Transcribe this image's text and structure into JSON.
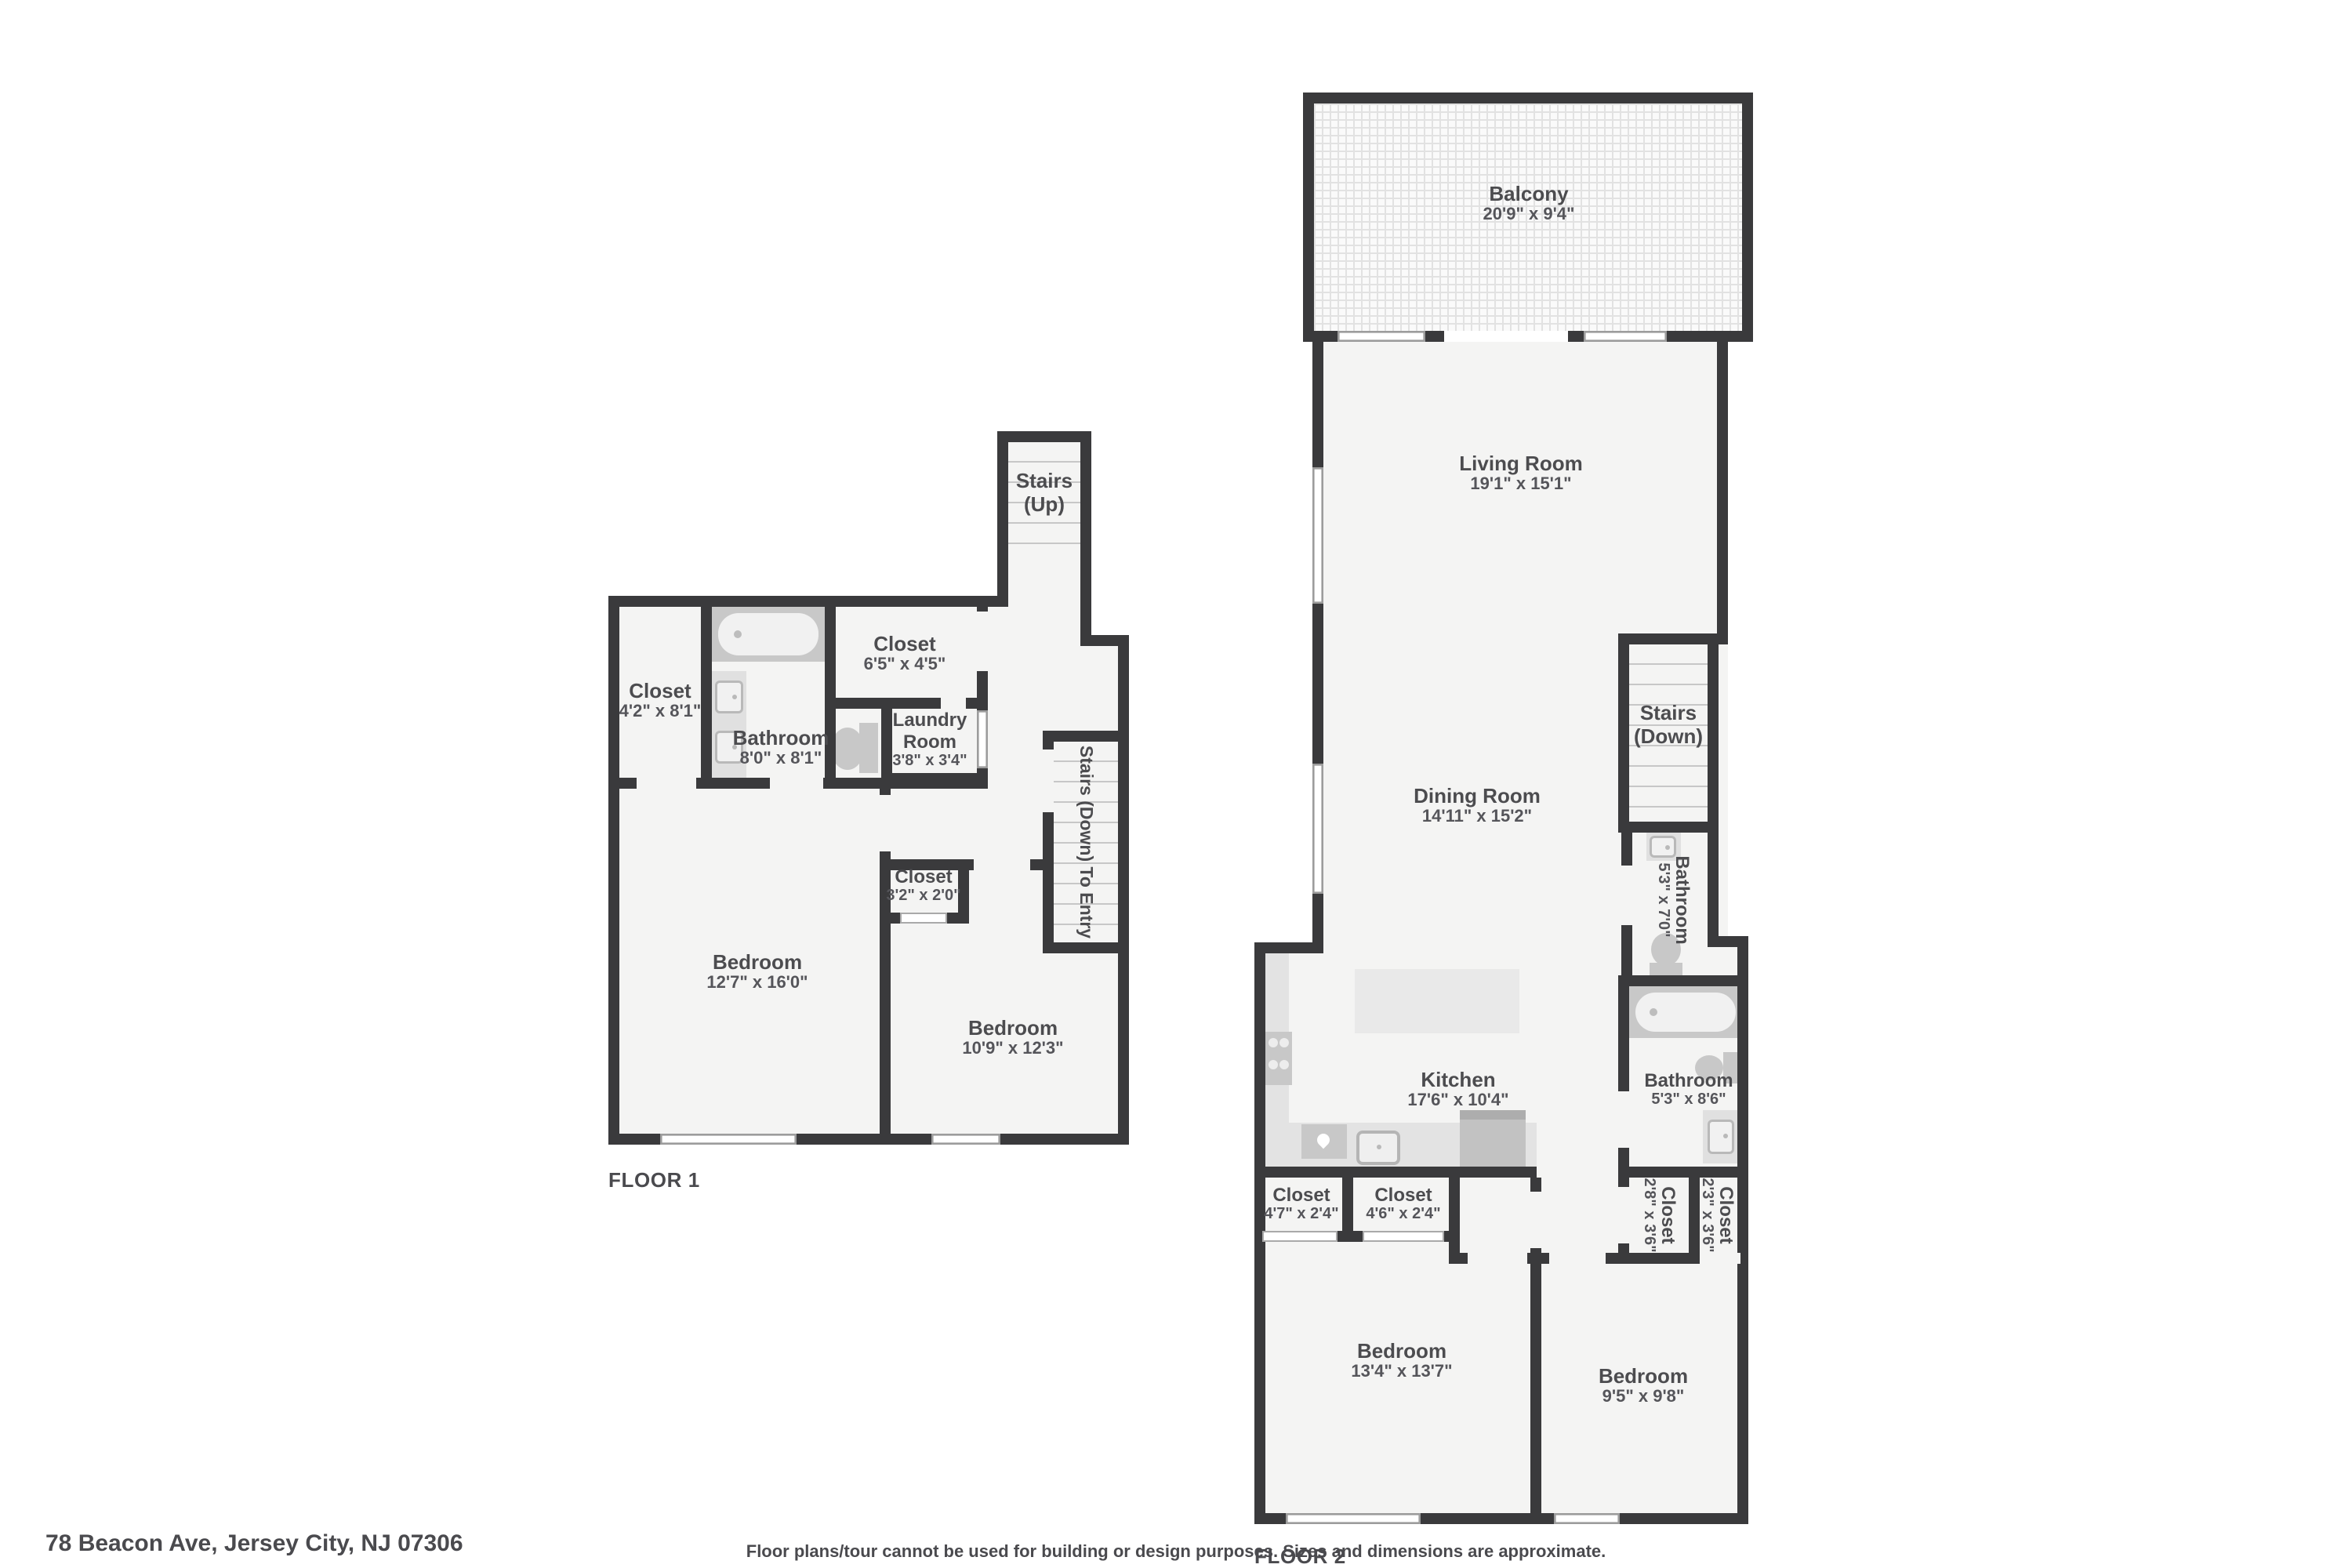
{
  "meta": {
    "address": "78 Beacon Ave, Jersey City, NJ 07306",
    "disclaimer": "Floor plans/tour cannot be used for building or design purposes. Sizes and dimensions are approximate."
  },
  "colors": {
    "wall": "#3a3a3c",
    "floor": "#f4f4f3",
    "fixture": "#c8c8c8",
    "fixture_light": "#e3e3e3",
    "text": "#4c4c4f",
    "balcony_tile_line": "#e2e2e2"
  },
  "floor1": {
    "label": "FLOOR 1",
    "rooms": {
      "closet_a": {
        "name": "Closet",
        "dims": "4'2\" x 8'1\""
      },
      "bathroom": {
        "name": "Bathroom",
        "dims": "8'0\" x 8'1\""
      },
      "closet_b": {
        "name": "Closet",
        "dims": "6'5\" x 4'5\""
      },
      "laundry": {
        "name": "Laundry Room",
        "dims": "3'8\" x 3'4\""
      },
      "stairs_up": {
        "name": "Stairs",
        "sub": "(Up)"
      },
      "stairs_entry": {
        "name": "Stairs (Down) To Entry"
      },
      "closet_c": {
        "name": "Closet",
        "dims": "3'2\" x 2'0\""
      },
      "bedroom_a": {
        "name": "Bedroom",
        "dims": "12'7\" x 16'0\""
      },
      "bedroom_b": {
        "name": "Bedroom",
        "dims": "10'9\" x 12'3\""
      }
    }
  },
  "floor2": {
    "label": "FLOOR 2",
    "rooms": {
      "balcony": {
        "name": "Balcony",
        "dims": "20'9\" x 9'4\""
      },
      "living": {
        "name": "Living Room",
        "dims": "19'1\" x 15'1\""
      },
      "dining": {
        "name": "Dining Room",
        "dims": "14'11\" x 15'2\""
      },
      "stairs_down": {
        "name": "Stairs",
        "sub": "(Down)"
      },
      "bathroom_a": {
        "name": "Bathroom",
        "dims": "5'3\" x 7'0\""
      },
      "bathroom_b": {
        "name": "Bathroom",
        "dims": "5'3\" x 8'6\""
      },
      "kitchen": {
        "name": "Kitchen",
        "dims": "17'6\" x 10'4\""
      },
      "closet_a": {
        "name": "Closet",
        "dims": "4'7\" x 2'4\""
      },
      "closet_b": {
        "name": "Closet",
        "dims": "4'6\" x 2'4\""
      },
      "closet_c": {
        "name": "Closet",
        "dims": "2'8\" x 3'6\""
      },
      "closet_d": {
        "name": "Closet",
        "dims": "2'3\" x 3'6\""
      },
      "bedroom_a": {
        "name": "Bedroom",
        "dims": "13'4\" x 13'7\""
      },
      "bedroom_b": {
        "name": "Bedroom",
        "dims": "9'5\" x 9'8\""
      }
    }
  }
}
